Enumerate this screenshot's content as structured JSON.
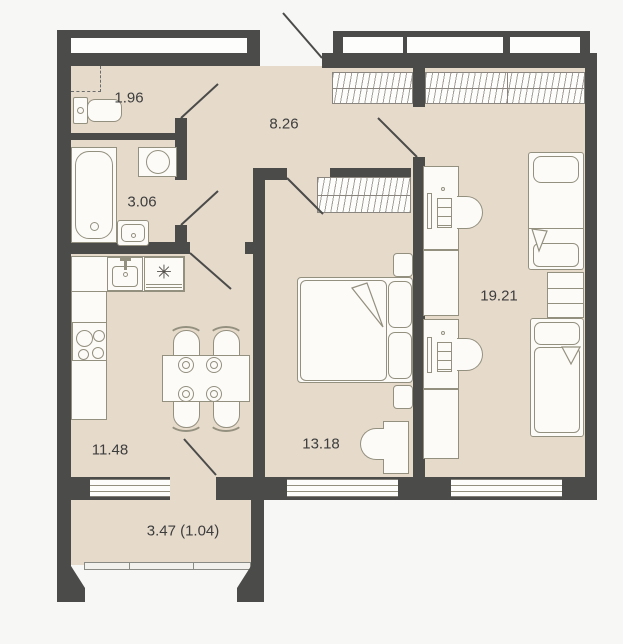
{
  "plan": {
    "type": "apartment-floor-plan",
    "rooms": [
      {
        "id": "wc",
        "area_label": "1.96"
      },
      {
        "id": "hallway",
        "area_label": "8.26"
      },
      {
        "id": "bathroom",
        "area_label": "3.06"
      },
      {
        "id": "kitchen",
        "area_label": "11.48"
      },
      {
        "id": "bedroom",
        "area_label": "13.18"
      },
      {
        "id": "living",
        "area_label": "19.21"
      },
      {
        "id": "balcony",
        "area_label": "3.47 (1.04)"
      }
    ],
    "symbols": {
      "stove": "✳"
    },
    "colors": {
      "wall": "#4b4b4a",
      "floor": "#e6dacb",
      "background": "#f7f7f6",
      "furniture_fill": "#fcfbf8",
      "furniture_stroke": "#94907f",
      "label_text": "#3d3d3d"
    }
  }
}
